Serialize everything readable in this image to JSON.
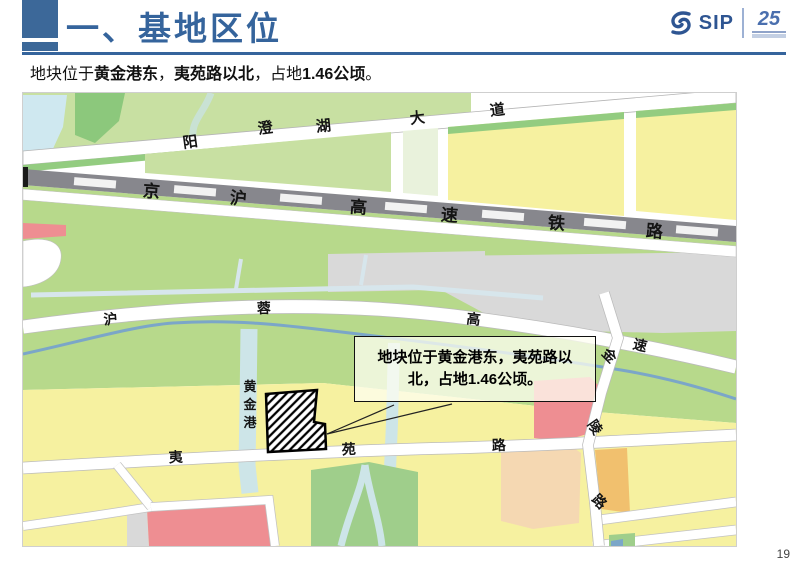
{
  "slide": {
    "title": "一、基地区位",
    "page_number": "19"
  },
  "subtitle": {
    "segments": [
      {
        "text": "地块位于",
        "bold": false
      },
      {
        "text": "黄金港东",
        "bold": true
      },
      {
        "text": "，",
        "bold": false
      },
      {
        "text": "夷苑路以北",
        "bold": true
      },
      {
        "text": "，占地",
        "bold": false
      },
      {
        "text": "1.46公顷",
        "bold": true
      },
      {
        "text": "。",
        "bold": false
      }
    ]
  },
  "logo": {
    "brand": "SIP",
    "anniversary": "25"
  },
  "colors": {
    "accent_blue": "#35649c",
    "map_yellow": "#f6f1a0",
    "map_green": "#b7d98b",
    "map_gray": "#d9d9d9",
    "railway_gray": "#87878d",
    "water_blue": "#cfe8f0",
    "river_blue": "#7ba6c8",
    "block_red": "#ee8e92",
    "block_peach": "#f5d8b2",
    "block_orange": "#f1c06e"
  },
  "map": {
    "callout_text": "地块位于黄金港东，夷苑路以北，占地1.46公顷。",
    "roads": [
      "阳澄湖大道",
      "京沪高速铁路",
      "沪蓉高速",
      "金陵路",
      "夷苑路"
    ],
    "water_features": [
      "黄金港"
    ],
    "site_area": "1.46公顷",
    "labels": [
      {
        "t": "阳",
        "x": 168,
        "y": 54,
        "r": -8,
        "s": 15,
        "g": "yangchenghu-avenue"
      },
      {
        "t": "澄",
        "x": 243,
        "y": 40,
        "r": -8,
        "s": 15,
        "g": "yangchenghu-avenue"
      },
      {
        "t": "湖",
        "x": 301,
        "y": 38,
        "r": -6,
        "s": 15,
        "g": "yangchenghu-avenue"
      },
      {
        "t": "大",
        "x": 395,
        "y": 30,
        "r": -7,
        "s": 15,
        "g": "yangchenghu-avenue"
      },
      {
        "t": "道",
        "x": 475,
        "y": 22,
        "r": -7,
        "s": 15,
        "g": "yangchenghu-avenue"
      },
      {
        "t": "京",
        "x": 128,
        "y": 104,
        "r": 4.5,
        "s": 17,
        "g": "jinghu-railway"
      },
      {
        "t": "沪",
        "x": 215,
        "y": 111,
        "r": 4.5,
        "s": 17,
        "g": "jinghu-railway"
      },
      {
        "t": "高",
        "x": 335,
        "y": 120,
        "r": 4.5,
        "s": 17,
        "g": "jinghu-railway"
      },
      {
        "t": "速",
        "x": 426,
        "y": 128,
        "r": 4.5,
        "s": 17,
        "g": "jinghu-railway"
      },
      {
        "t": "铁",
        "x": 533,
        "y": 136,
        "r": 4.5,
        "s": 17,
        "g": "jinghu-railway"
      },
      {
        "t": "路",
        "x": 631,
        "y": 144,
        "r": 4.5,
        "s": 17,
        "g": "jinghu-railway"
      },
      {
        "t": "沪",
        "x": 88,
        "y": 231,
        "r": -5,
        "s": 14,
        "g": "hurong-expressway"
      },
      {
        "t": "蓉",
        "x": 241,
        "y": 220,
        "r": -2,
        "s": 14,
        "g": "hurong-expressway"
      },
      {
        "t": "高",
        "x": 450,
        "y": 231,
        "r": 7,
        "s": 14,
        "g": "hurong-expressway"
      },
      {
        "t": "速",
        "x": 616,
        "y": 257,
        "r": 13,
        "s": 14,
        "g": "hurong-expressway"
      },
      {
        "t": "金",
        "x": 583,
        "y": 266,
        "r": 45,
        "s": 14,
        "g": "jinling-road"
      },
      {
        "t": "陵",
        "x": 568,
        "y": 337,
        "r": 55,
        "s": 14,
        "g": "jinling-road"
      },
      {
        "t": "路",
        "x": 573,
        "y": 412,
        "r": 45,
        "s": 14,
        "g": "jinling-road"
      },
      {
        "t": "夷",
        "x": 153,
        "y": 369,
        "r": -3,
        "s": 14,
        "g": "yiyuan-road"
      },
      {
        "t": "苑",
        "x": 326,
        "y": 361,
        "r": -3,
        "s": 14,
        "g": "yiyuan-road"
      },
      {
        "t": "路",
        "x": 476,
        "y": 357,
        "r": -2,
        "s": 14,
        "g": "yiyuan-road"
      },
      {
        "t": "黄",
        "x": 227,
        "y": 298,
        "r": 0,
        "s": 13,
        "g": "huangjingang-canal"
      },
      {
        "t": "金",
        "x": 227,
        "y": 316,
        "r": 0,
        "s": 13,
        "g": "huangjingang-canal"
      },
      {
        "t": "港",
        "x": 227,
        "y": 334,
        "r": 0,
        "s": 13,
        "g": "huangjingang-canal"
      }
    ]
  }
}
